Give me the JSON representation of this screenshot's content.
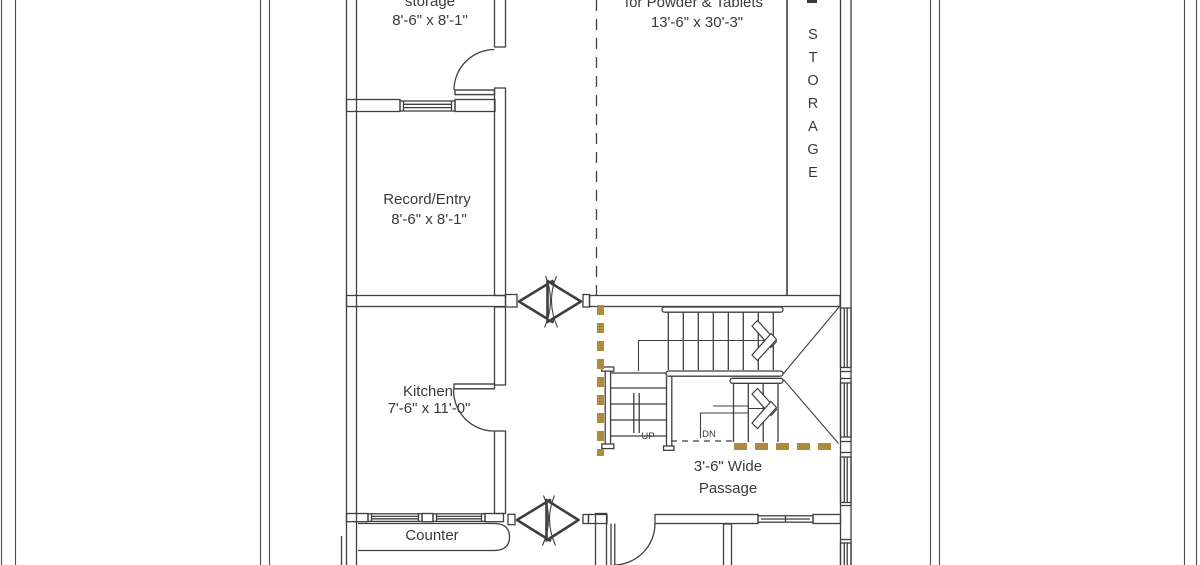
{
  "rooms": {
    "storage_top": {
      "label": "storage",
      "dims": "8'-6\" x 8'-1\""
    },
    "main_hall": {
      "label": "for Powder & Tablets",
      "dims": "13'-6\" x 30'-3\""
    },
    "record_entry": {
      "label": "Record/Entry",
      "dims": "8'-6\" x 8'-1\""
    },
    "kitchen": {
      "label": "Kitchen",
      "dims": "7'-6\" x 11'-0\""
    },
    "side_storage": {
      "label": "STORAGE"
    },
    "counter": {
      "label": "Counter"
    },
    "passage": {
      "line1": "3'-6\" Wide",
      "line2": "Passage"
    }
  },
  "stairs": {
    "up": "UP",
    "down": "DN"
  },
  "colors": {
    "wall_line": "#3f3f3f",
    "accent_dashed": "#ae8a3d",
    "text": "#3a3a3a",
    "background": "#ffffff"
  }
}
